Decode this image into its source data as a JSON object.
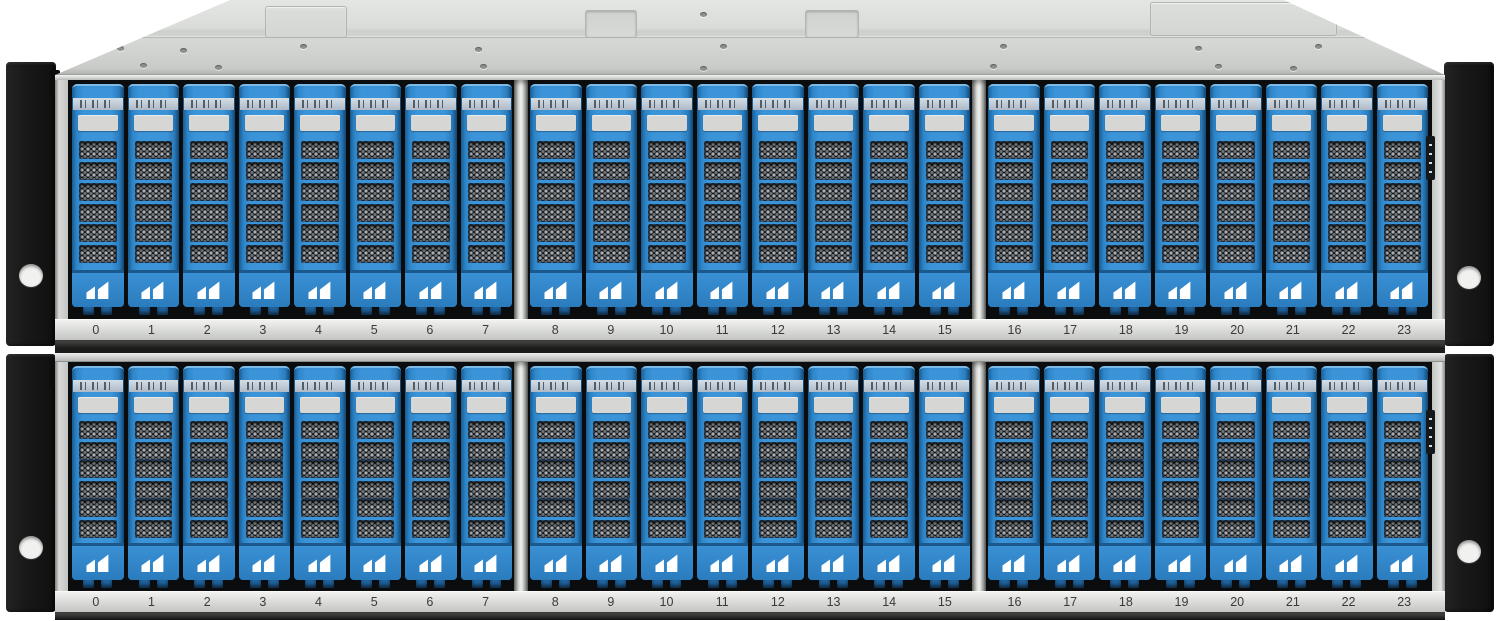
{
  "layout": {
    "group_size": 8,
    "groups_per_shelf": 3,
    "shelf_count": 2
  },
  "shelves": [
    {
      "id": "upper",
      "slot_labels": [
        "0",
        "1",
        "2",
        "3",
        "4",
        "5",
        "6",
        "7",
        "8",
        "9",
        "10",
        "11",
        "12",
        "13",
        "14",
        "15",
        "16",
        "17",
        "18",
        "19",
        "20",
        "21",
        "22",
        "23"
      ]
    },
    {
      "id": "lower",
      "slot_labels": [
        "0",
        "1",
        "2",
        "3",
        "4",
        "5",
        "6",
        "7",
        "8",
        "9",
        "10",
        "11",
        "12",
        "13",
        "14",
        "15",
        "16",
        "17",
        "18",
        "19",
        "20",
        "21",
        "22",
        "23"
      ]
    }
  ],
  "drive": {
    "logo_icon": "dual-sail-logo",
    "logo_color": "#ffffff",
    "label_plate_text": "",
    "barcode_icon": "barcode-label"
  },
  "colors": {
    "bg_white": "#ffffff",
    "drive_blue": "#3b93d8",
    "cap_highlight": "#7cbbe7",
    "barcode_ink": "#3f4a55",
    "label_plate": "#d6d7d4",
    "mesh_dark": "#121417",
    "mesh_metal": "#a9afb3",
    "strip_text": "#3a3a3a",
    "ear_black": "#181818"
  }
}
